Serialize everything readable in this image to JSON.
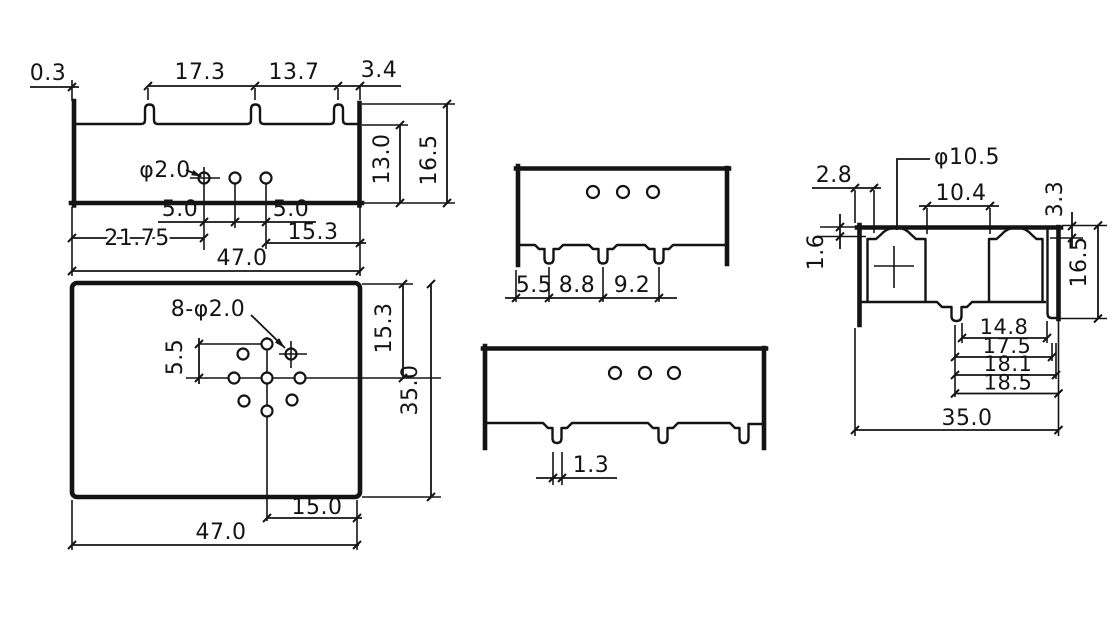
{
  "drawing": {
    "type": "mechanical-part-dimension-drawing",
    "line_color": "#141414",
    "background": "#ffffff",
    "views": {
      "front_section": {
        "dims": {
          "wall_offset": "0.3",
          "tab_pitch_1": "17.3",
          "tab_pitch_2": "13.7",
          "tab_edge": "3.4",
          "hole_dia": "φ2.0",
          "hole_pitch_a": "5.0",
          "hole_pitch_b": "5.0",
          "hole_offset_left": "21.75",
          "hole_offset_right": "15.3",
          "inner_height": "13.0",
          "overall_height": "16.5",
          "overall_width": "47.0"
        }
      },
      "top_view": {
        "dims": {
          "holes_note": "8-φ2.0",
          "hole_row_pitch": "5.5",
          "center_offset_y": "15.3",
          "overall_depth": "35.0",
          "center_offset_x": "15.0",
          "overall_width": "47.0"
        }
      },
      "side_view_a": {
        "dims": {
          "pin_off_1": "5.5",
          "pin_pitch_1": "8.8",
          "pin_pitch_2": "9.2"
        }
      },
      "side_view_b": {
        "dims": {
          "pin_width": "1.3"
        }
      },
      "end_view": {
        "dims": {
          "edge_offset": "2.8",
          "cavity_dia": "φ10.5",
          "cavity_gap": "10.4",
          "lip_depth": "3.3",
          "top_wall": "1.6",
          "overall_height": "16.5",
          "span_1": "14.8",
          "span_2": "17.5",
          "span_3": "18.1",
          "span_4": "18.5",
          "overall_width": "35.0"
        }
      }
    }
  }
}
